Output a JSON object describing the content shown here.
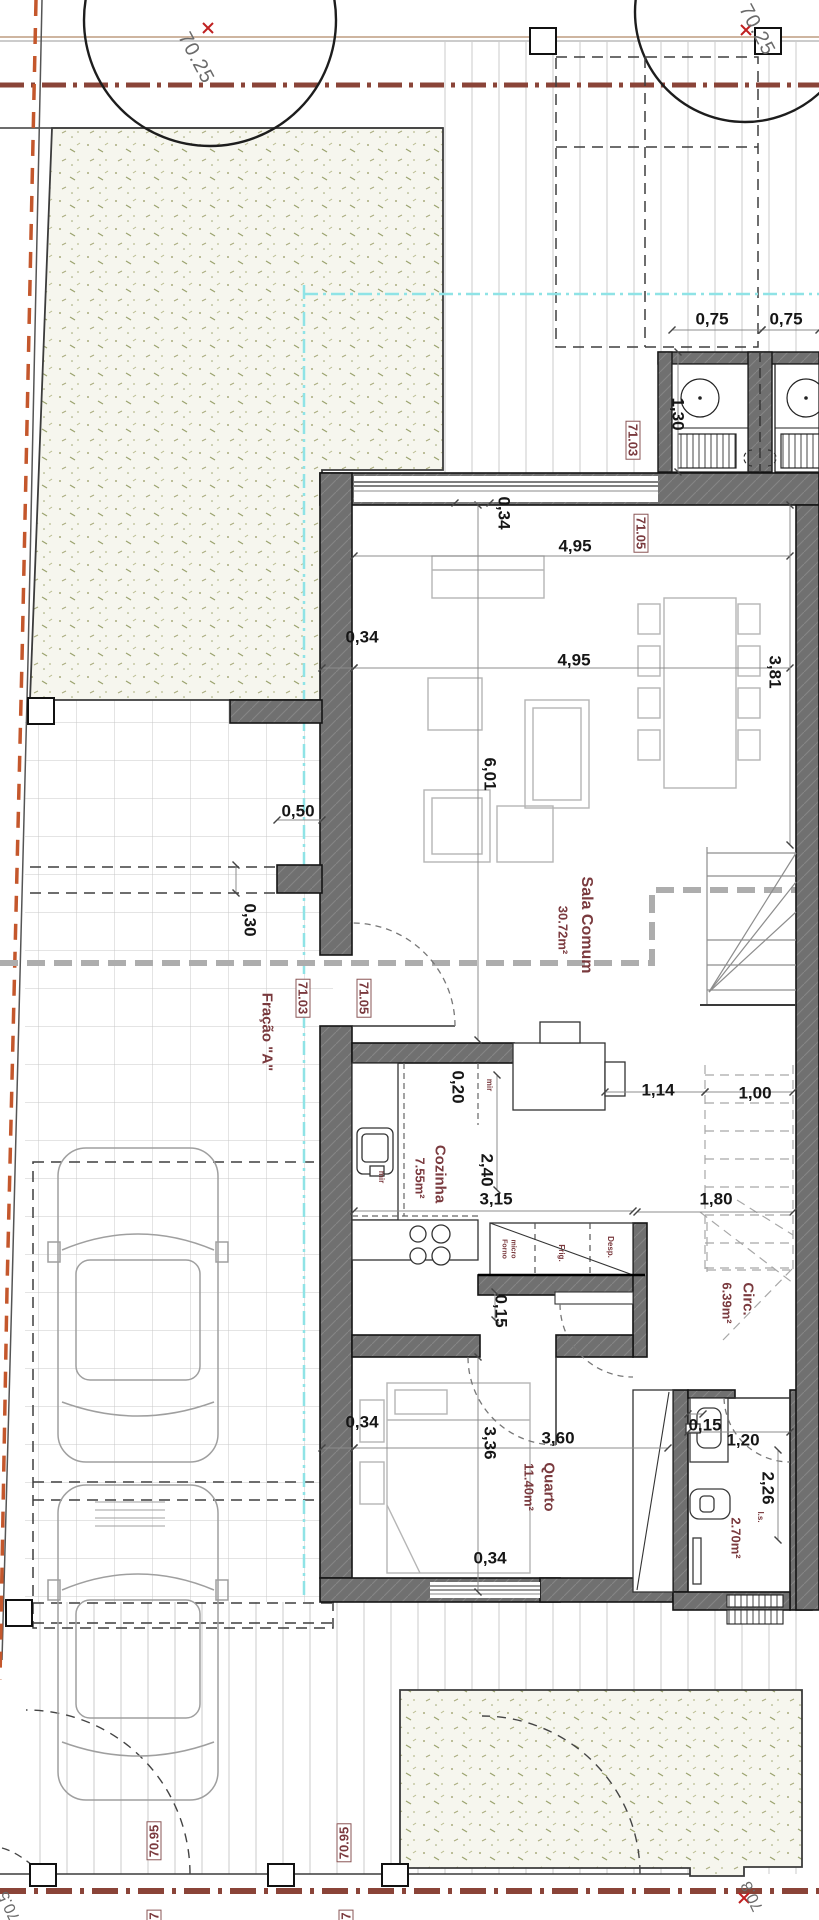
{
  "plan": {
    "fraction": "Fração \"A\"",
    "rooms": {
      "sala": {
        "name": "Sala Comum",
        "area": "30.72m²"
      },
      "cozinha": {
        "name": "Cozinha",
        "area": "7.55m²"
      },
      "quarto": {
        "name": "Quarto",
        "area": "11.40m²"
      },
      "circ": {
        "name": "Circ.",
        "area": "6.39m²"
      },
      "is": {
        "name": "I.s.",
        "area": "2.70m²"
      }
    },
    "fixtures": {
      "forno_line1": "Forno",
      "forno_line2": "micro",
      "frig": "Frig.",
      "desp": "Desp.",
      "mir": "mir"
    },
    "levels": {
      "l7025": "70.25",
      "l7103": "71.03",
      "l7105": "71.05",
      "l7095": "70.95",
      "l708": "70.8",
      "l705": "70.5",
      "l7_partial": "7"
    },
    "dims": {
      "d075": "0,75",
      "d130": "1,30",
      "d034": "0,34",
      "d495": "4,95",
      "d381": "3,81",
      "d601": "6,01",
      "d050": "0,50",
      "d030": "0,30",
      "d020": "0,20",
      "d114": "1,14",
      "d100": "1,00",
      "d240": "2,40",
      "d315": "3,15",
      "d180": "1,80",
      "d015": "0,15",
      "d336": "3,36",
      "d360": "3,60",
      "d120": "1,20",
      "d226": "2,26"
    },
    "colors": {
      "wall": "#707070",
      "room_label": "#7a3a3e",
      "boundary_dash": "#8a4438",
      "property_dash": "#c4572c",
      "setback_cyan": "#8fe3e6",
      "garden_dot": "#a9ac7e"
    }
  }
}
